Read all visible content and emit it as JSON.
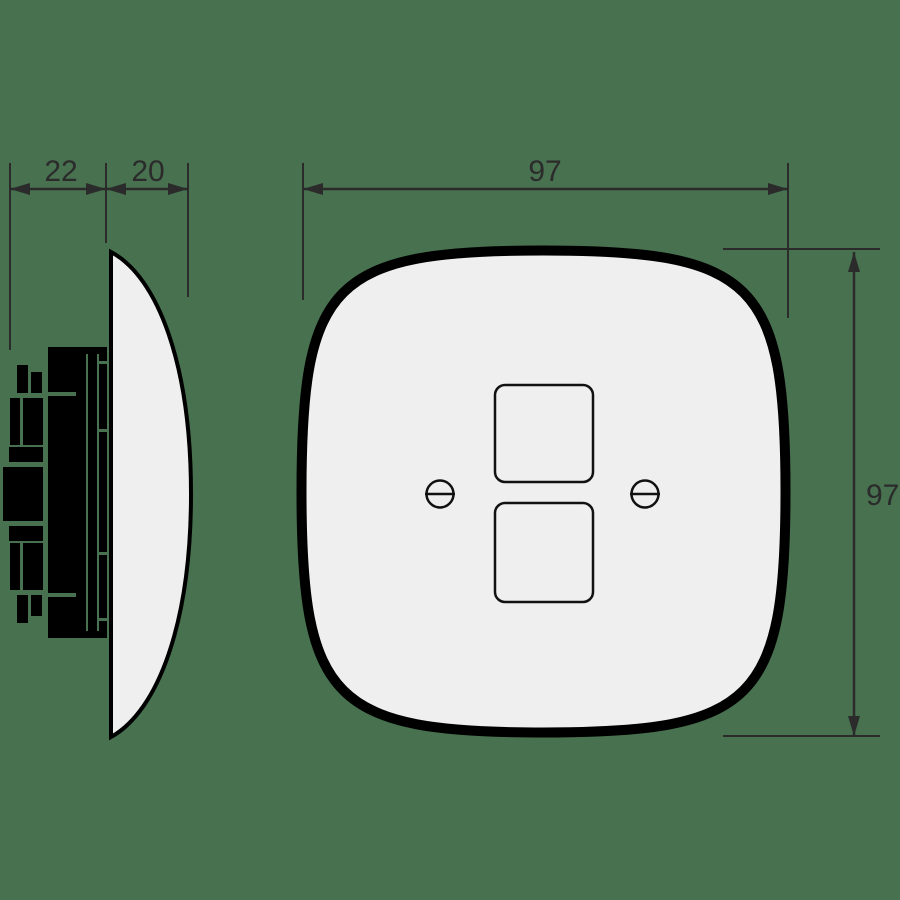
{
  "drawing": {
    "type": "technical-dimension-drawing",
    "subject": "wall plate with two square openings and mounting mechanism",
    "views": {
      "side_view": {
        "dimensions": {
          "mechanism_depth": {
            "value": "22"
          },
          "plate_depth": {
            "value": "20"
          }
        }
      },
      "front_view": {
        "dimensions": {
          "plate_width": {
            "value": "97"
          },
          "plate_height": {
            "value": "97"
          }
        },
        "features": {
          "square_openings": 2,
          "screws": 2
        }
      }
    }
  },
  "colors": {
    "background": "#47714F",
    "plate_fill": "#EFEFEF",
    "outline": "#000000",
    "dimension_line": "#2B2B2B",
    "mechanism_silhouette": "#000000"
  }
}
